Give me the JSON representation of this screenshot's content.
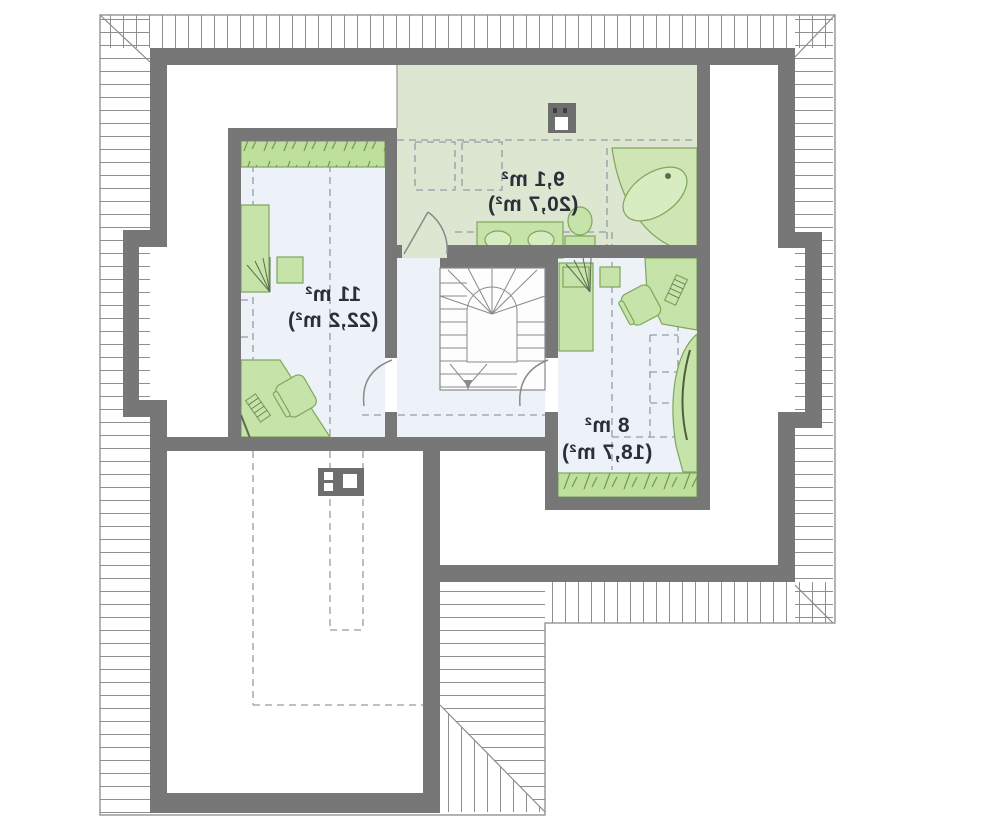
{
  "plan": {
    "type": "attic-floor-plan",
    "text_mirrored": true,
    "rooms": [
      {
        "name": "left-room",
        "area": "11 m²",
        "total_area": "(22,2 m²)"
      },
      {
        "name": "bathroom",
        "area": "9,1 m²",
        "total_area": "(20,7 m²)"
      },
      {
        "name": "right-room",
        "area": "8 m²",
        "total_area": "(18,7 m²)"
      }
    ],
    "colors": {
      "walls": "#777777",
      "room_floor": "#edf1f8",
      "bathroom_floor": "#dce6d1",
      "furniture_fill": "#c6e4a9",
      "furniture_outline": "#7fa65c",
      "wardrobe_fill": "#bfe09d",
      "hatch_line": "#8f8f8f",
      "dashed_line": "#959ca6",
      "label_text": "#2b2f3a",
      "outline": "#9b9b9b"
    }
  }
}
